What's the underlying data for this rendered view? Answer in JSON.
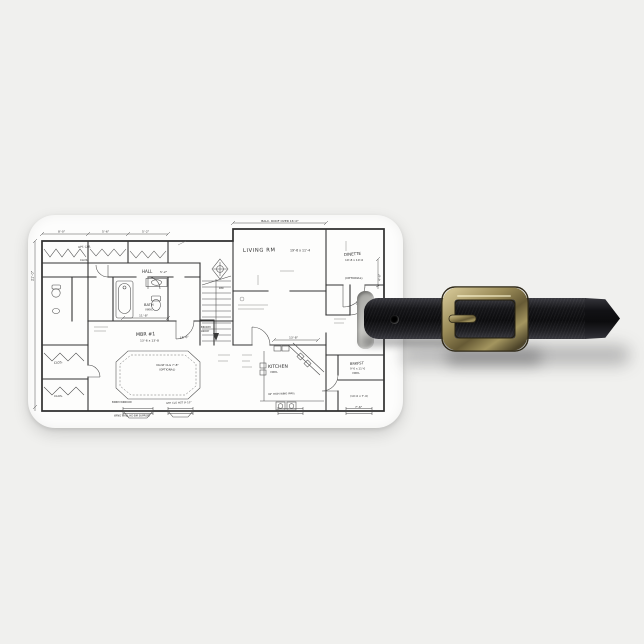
{
  "product": {
    "item": "luggage tag",
    "print": "hand-drawn house floor plan blueprint"
  },
  "colors": {
    "background": "#f0f0ee",
    "tag_face": "#fdfdfc",
    "ink": "#2d2d2d",
    "leather": "#111114",
    "brass": "#9a8b58",
    "slot": "#b4b4b0"
  },
  "plan": {
    "labels": {
      "balc_note": "BALC. ROOF OVER 16'-0\"",
      "living": "LIVING RM",
      "living_dims": "19'-6 x 11'-4",
      "dinette": "DINETTE",
      "dinette_dims": "10'-8 x 10'-0",
      "optional": "(OPTIONAL)",
      "hall": "HALL",
      "dim_52": "5'-2\"",
      "bath": "BATH",
      "vinyl": "VINYL",
      "mbr": "MBR #1",
      "mbr_dims": "13'-6 x 13'-8",
      "dim_150": "15'-0\"",
      "vault": "VAULT CLG 7'-8\"",
      "kitchen": "KITCHEN",
      "brkfst": "BRKFST",
      "brkfst_dims": "9'-0 x 11'-0",
      "clos": "CLOS.",
      "opt_cab": "OPT. CAB.",
      "broom": "BROOM",
      "lndry": "LNDRY",
      "dn": "DN",
      "wing_note": "36\" HIGH WING WALL",
      "gyp_note": "GYP. CLG HGT 9'-10\"",
      "bdrm_note": "BDRM WINDOW",
      "support_note": "WING WALL HD BM SUPPORT",
      "dim_21": "21'-0\"",
      "dim_80": "8'-0\"",
      "dim_56": "5'-6\"",
      "dim_118": "11'-8\"",
      "dim_138": "13'-8\"",
      "dim_76": "7'-6\"",
      "dim_46": "4'-6\"",
      "room_br": "(14'-0 x 7'-0)"
    }
  }
}
